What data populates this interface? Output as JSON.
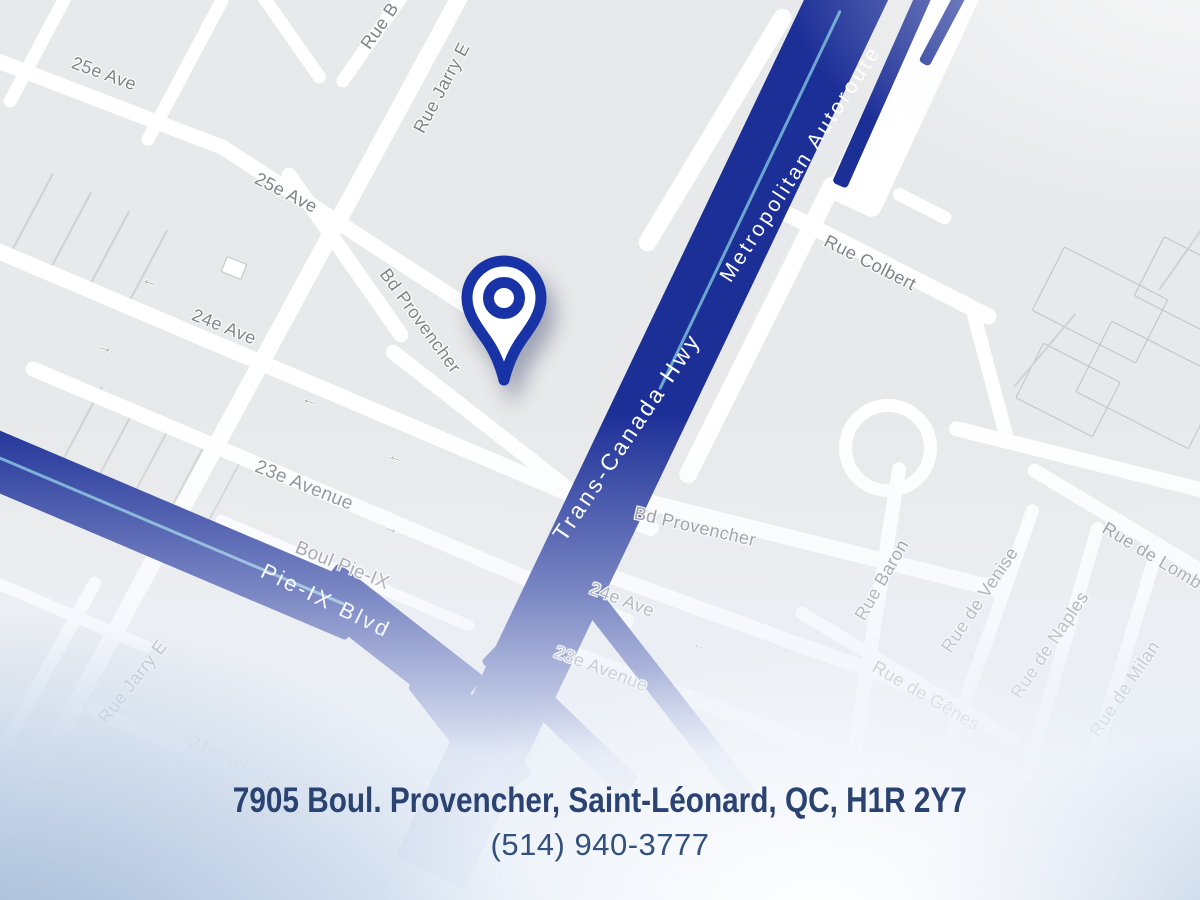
{
  "footer": {
    "address": "7905 Boul. Provencher, Saint-Léonard, QC, H1R 2Y7",
    "phone": "(514) 940-3777"
  },
  "colors": {
    "highway_blue": "#1c2f97",
    "pin_blue": "#1733a6",
    "street_label_gray": "#7f838a",
    "address_navy": "#2b4371",
    "map_background": "#e8e9ea"
  },
  "map": {
    "pin_name": "location-pin",
    "labels": [
      {
        "text": "25e Ave",
        "x": 104,
        "y": 74,
        "rot": 20,
        "style": "st"
      },
      {
        "text": "25e Ave",
        "x": 286,
        "y": 193,
        "rot": 27,
        "style": "st"
      },
      {
        "text": "Rue Jarry E",
        "x": 442,
        "y": 88,
        "rot": -62,
        "style": "st"
      },
      {
        "text": "Rue Jarry E",
        "x": 133,
        "y": 682,
        "rot": -52,
        "style": "st"
      },
      {
        "text": "24e Ave",
        "x": 224,
        "y": 327,
        "rot": 22,
        "style": "st"
      },
      {
        "text": "Bd Provencher",
        "x": 420,
        "y": 321,
        "rot": 54,
        "style": "st"
      },
      {
        "text": "23e Avenue",
        "x": 304,
        "y": 486,
        "rot": 22,
        "style": "st",
        "size": 19
      },
      {
        "text": "Boul Pie-IX",
        "x": 342,
        "y": 566,
        "rot": 22,
        "style": "st",
        "size": 19
      },
      {
        "text": "21e Avenue",
        "x": 235,
        "y": 762,
        "rot": 25,
        "style": "st"
      },
      {
        "text": "Rue Colbert",
        "x": 870,
        "y": 263,
        "rot": 27,
        "style": "st"
      },
      {
        "text": "Bd Provencher",
        "x": 695,
        "y": 527,
        "rot": 13,
        "style": "st"
      },
      {
        "text": "24e Ave",
        "x": 622,
        "y": 600,
        "rot": 21,
        "style": "st"
      },
      {
        "text": "23e Avenue",
        "x": 601,
        "y": 669,
        "rot": 21,
        "style": "st"
      },
      {
        "text": "Rue Baron",
        "x": 882,
        "y": 580,
        "rot": -60,
        "style": "st"
      },
      {
        "text": "Rue de Venise",
        "x": 980,
        "y": 600,
        "rot": -56,
        "style": "st"
      },
      {
        "text": "Rue de Naples",
        "x": 1050,
        "y": 645,
        "rot": -56,
        "style": "st"
      },
      {
        "text": "Rue de Milan",
        "x": 1125,
        "y": 689,
        "rot": -56,
        "style": "st"
      },
      {
        "text": "Rue de Gênes",
        "x": 926,
        "y": 696,
        "rot": 30,
        "style": "st"
      },
      {
        "text": "Rue de Lomb",
        "x": 1152,
        "y": 556,
        "rot": 31,
        "style": "st"
      },
      {
        "text": "Rue B",
        "x": 380,
        "y": 26,
        "rot": -55,
        "style": "st"
      },
      {
        "text": "Trans-Canada Hwy",
        "x": 627,
        "y": 437,
        "rot": -56,
        "style": "hw",
        "size": 23
      },
      {
        "text": "Metropolitan Autoroute",
        "x": 801,
        "y": 164,
        "rot": -57,
        "style": "hw",
        "size": 21
      },
      {
        "text": "Pie-IX Blvd",
        "x": 326,
        "y": 601,
        "rot": 26,
        "style": "hw",
        "size": 22
      }
    ]
  }
}
